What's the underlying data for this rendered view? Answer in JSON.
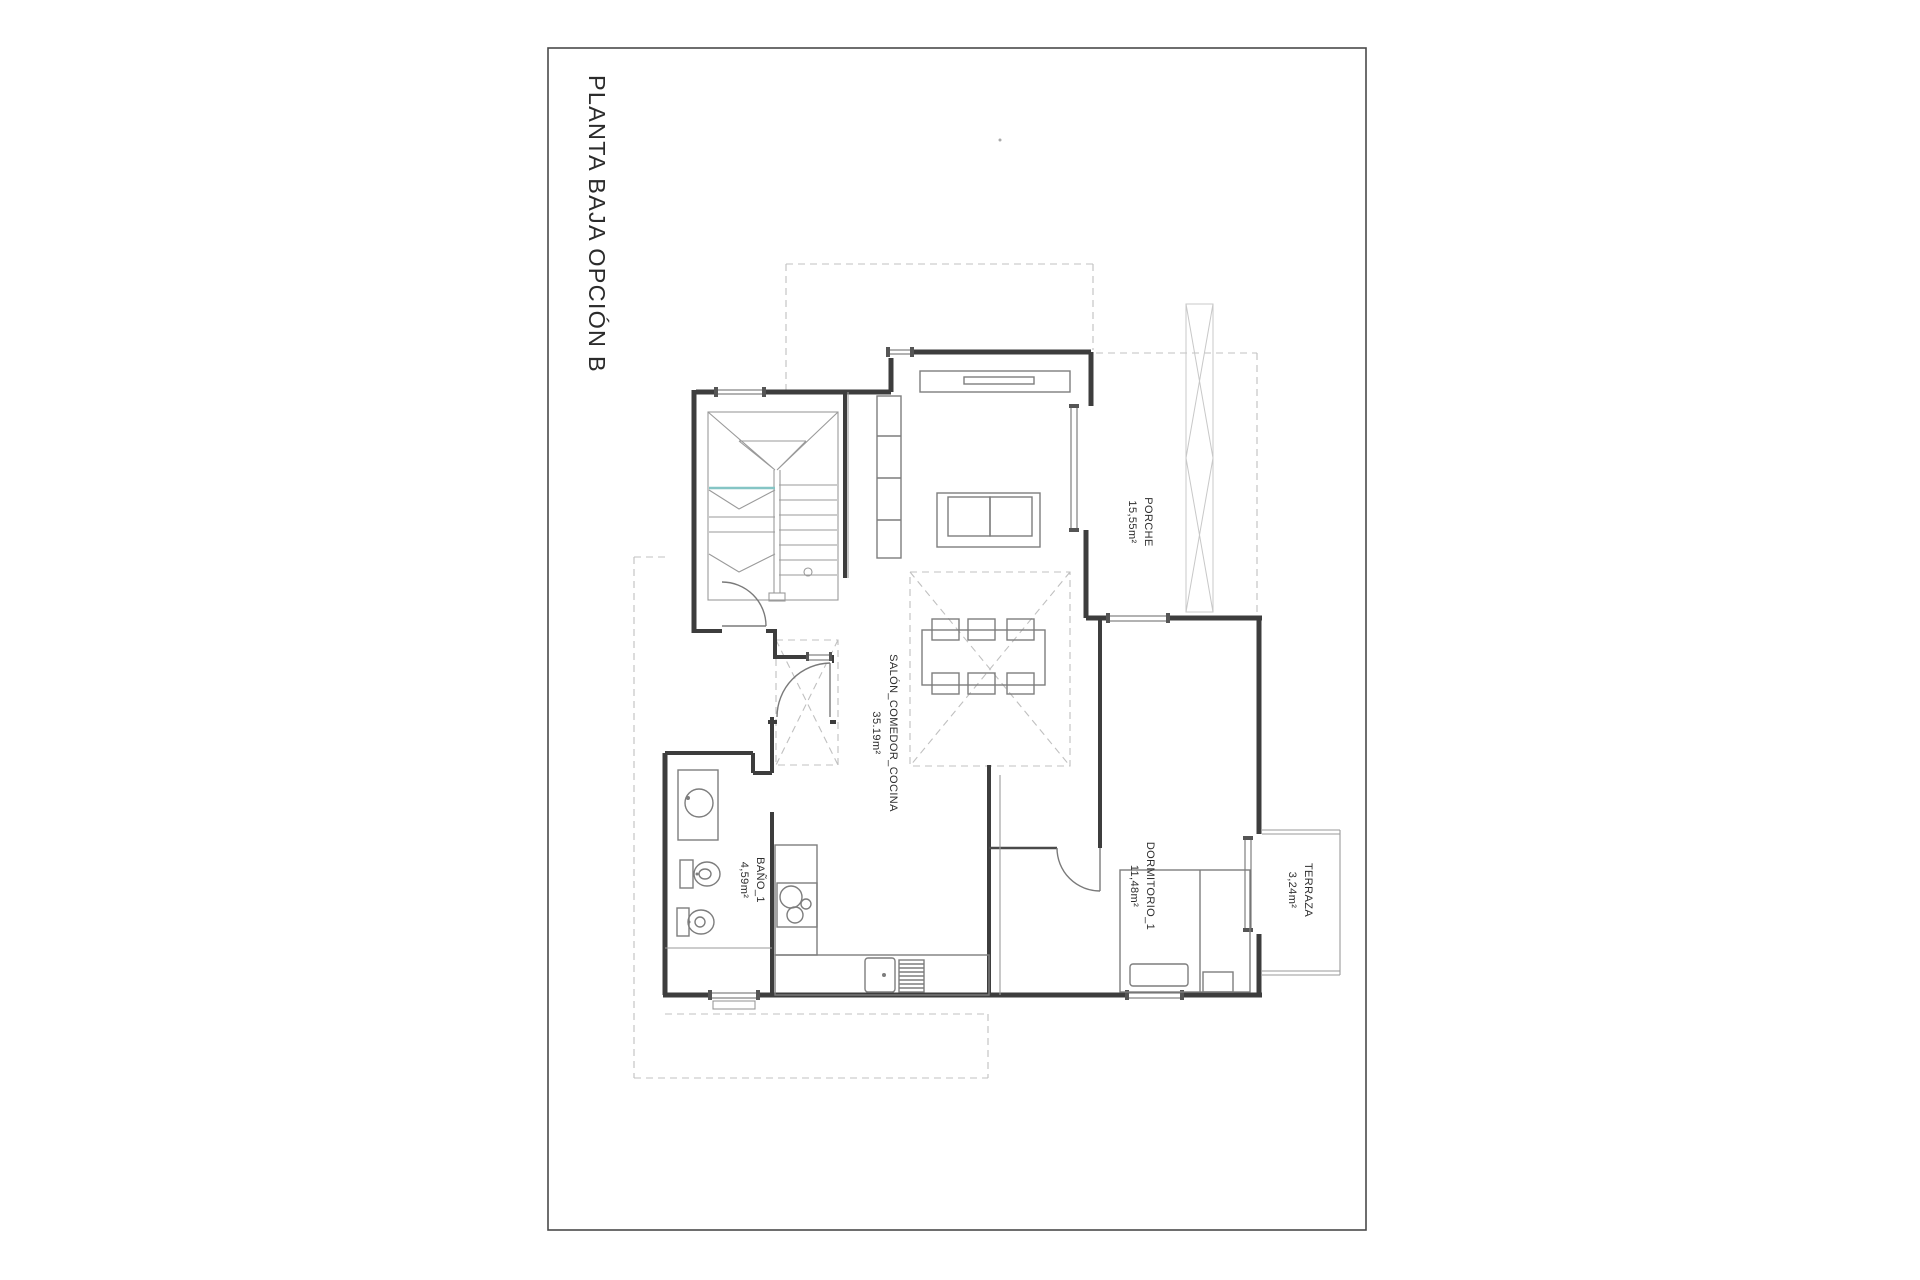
{
  "page": {
    "background": "#ffffff"
  },
  "title_block": {
    "title": "PLANTA BAJA OPCIÓN B"
  },
  "rooms": [
    {
      "name": "PORCHE",
      "area": "15,55m²"
    },
    {
      "name": "SALÓN_COMEDOR_COCINA",
      "area": "35.19m²"
    },
    {
      "name": "BAÑO_1",
      "area": "4,59m²"
    },
    {
      "name": "DORMITORIO_1",
      "area": "11,48m²"
    },
    {
      "name": "TERRAZA",
      "area": "3,24m²"
    }
  ],
  "colors": {
    "wall": "#3d3d3d",
    "thin_line": "#9a9a9a",
    "dashed_line": "#c0c0c0",
    "accent_teal": "#85c5c5",
    "text": "#2e2e2e"
  }
}
